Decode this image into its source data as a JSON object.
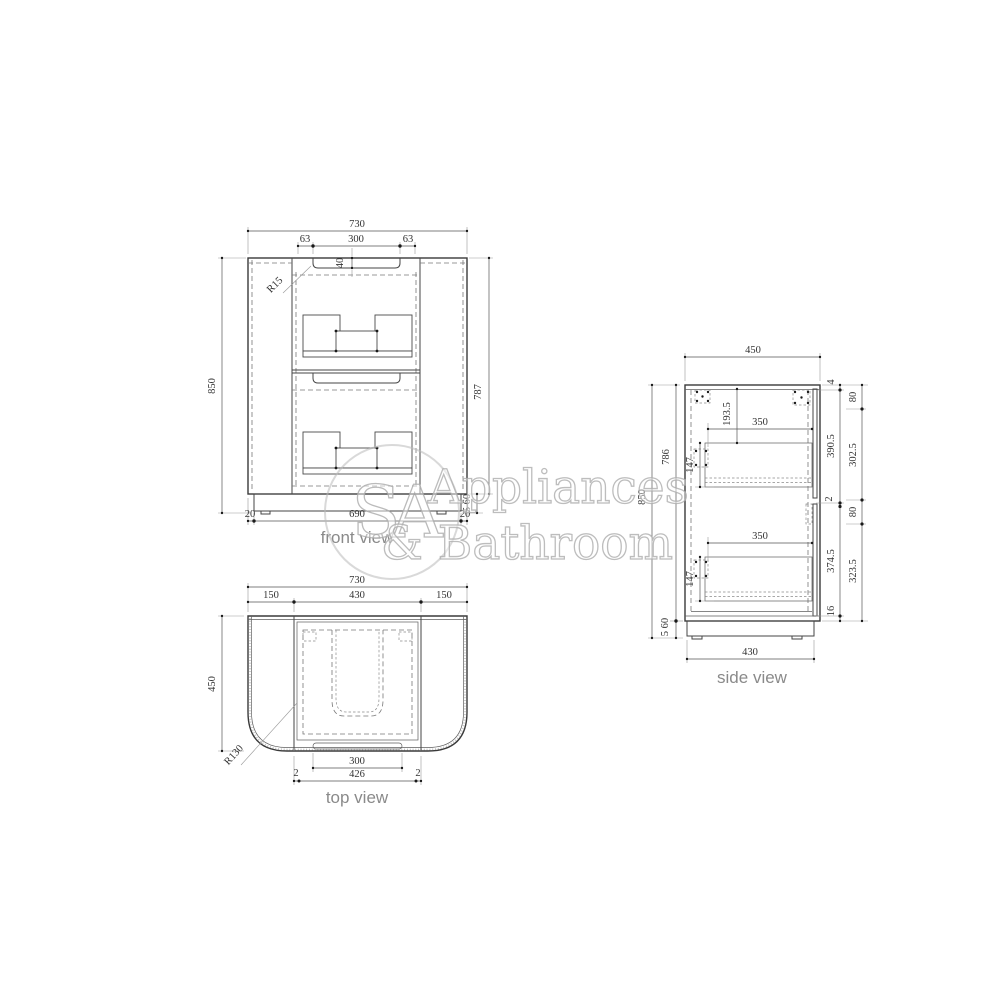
{
  "colors": {
    "background": "#ffffff",
    "drawing_line": "#3a3a3a",
    "dimension_text": "#333333",
    "view_label": "#8a8a8a",
    "watermark": "#bbbbbb"
  },
  "watermark": {
    "monogram": "SA",
    "line1": "Appliances",
    "line2": "& Bathroom"
  },
  "views": {
    "front": {
      "label": "front view",
      "overall_width": "730",
      "recess_segments": [
        "63",
        "300",
        "63"
      ],
      "recess_depth": "40",
      "recess_radius": "R15",
      "overall_height": "850",
      "body_height": "787",
      "kick_height": "5 60",
      "base_segments": [
        "20",
        "690",
        "20"
      ]
    },
    "top": {
      "label": "top view",
      "overall_width": "730",
      "width_segments": [
        "150",
        "430",
        "150"
      ],
      "overall_depth": "450",
      "corner_radius": "R130",
      "recess_width": "300",
      "inner_width": "426",
      "side_gaps": [
        "2",
        "2"
      ]
    },
    "side": {
      "label": "side view",
      "top_width": "450",
      "base_width": "430",
      "overall_height": "850",
      "body_height": "786",
      "kick_height": "5 60",
      "drawer_top_offset": "193.5",
      "drawers": [
        {
          "depth": "350",
          "height": "147"
        },
        {
          "depth": "350",
          "height": "147"
        }
      ],
      "right_chain_inner": [
        "4",
        "390.5",
        "2",
        "374.5",
        "16"
      ],
      "right_chain_outer": [
        "80",
        "302.5",
        "80",
        "323.5"
      ]
    }
  }
}
